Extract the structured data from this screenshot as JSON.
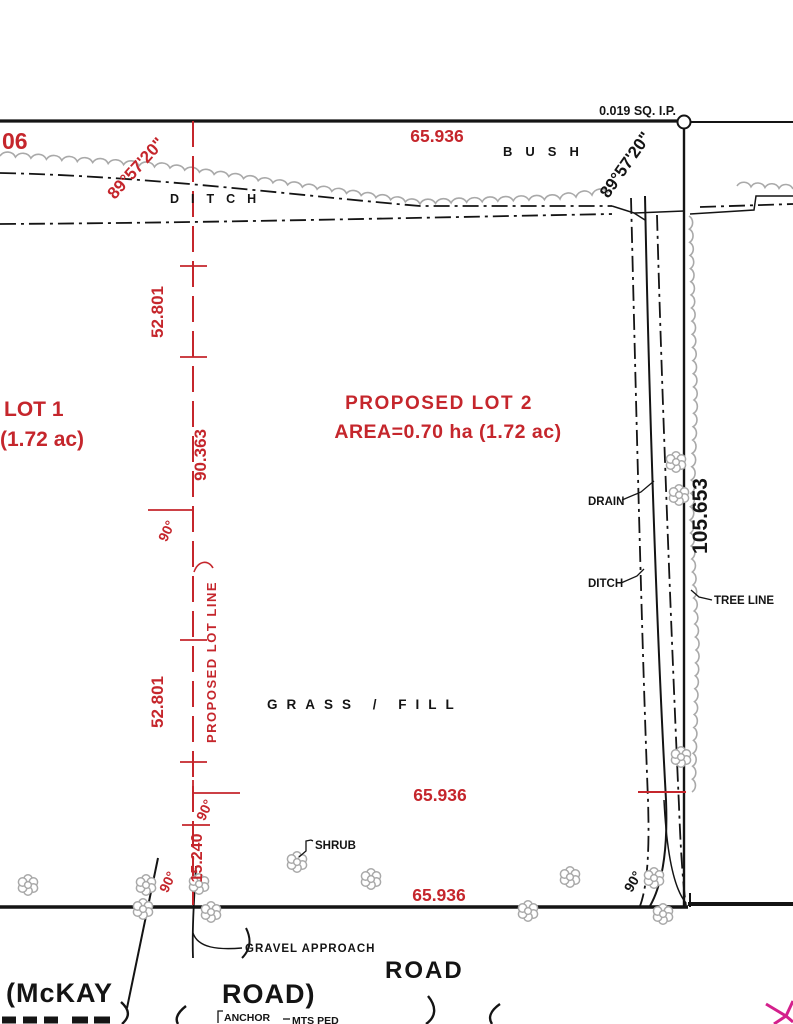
{
  "colors": {
    "red": "#c5262c",
    "black": "#141414",
    "gray": "#a9a9a9",
    "pink": "#d4208c"
  },
  "corner_marker": {
    "label": "0.019 SQ. I.P."
  },
  "lots": {
    "lot1_title": "LOT 1",
    "lot1_area": "(1.72 ac)",
    "lot2_title": "PROPOSED LOT 2",
    "lot2_area": "AREA=0.70 ha (1.72 ac)",
    "lot_line_label": "PROPOSED LOT LINE"
  },
  "features": {
    "bush": "BUSH",
    "ditch_top": "DITCH",
    "grass_fill": "GRASS / FILL",
    "drain": "DRAIN",
    "ditch_right": "DITCH",
    "tree_line": "TREE LINE",
    "shrub": "SHRUB",
    "gravel_approach": "GRAVEL APPROACH",
    "road_label": "ROAD",
    "road_name_left": "(McKAY",
    "road_name_right": "ROAD)",
    "anchor": "ANCHOR",
    "mts_ped": "MTS PED"
  },
  "dimensions": {
    "partial_left": "06",
    "top_width": "65.936",
    "mid_width": "65.936",
    "bottom_width": "65.936",
    "right_depth": "105.653",
    "seg_upper": "52.801",
    "seg_total": "90.363",
    "seg_lower": "52.801",
    "approach_offset": "15.240",
    "angle_nw": "89°57'20\"",
    "angle_ne": "89°57'20\"",
    "angle_mid": "90°",
    "angle_low": "90°",
    "angle_road_left": "90°",
    "angle_road_right": "90°"
  }
}
